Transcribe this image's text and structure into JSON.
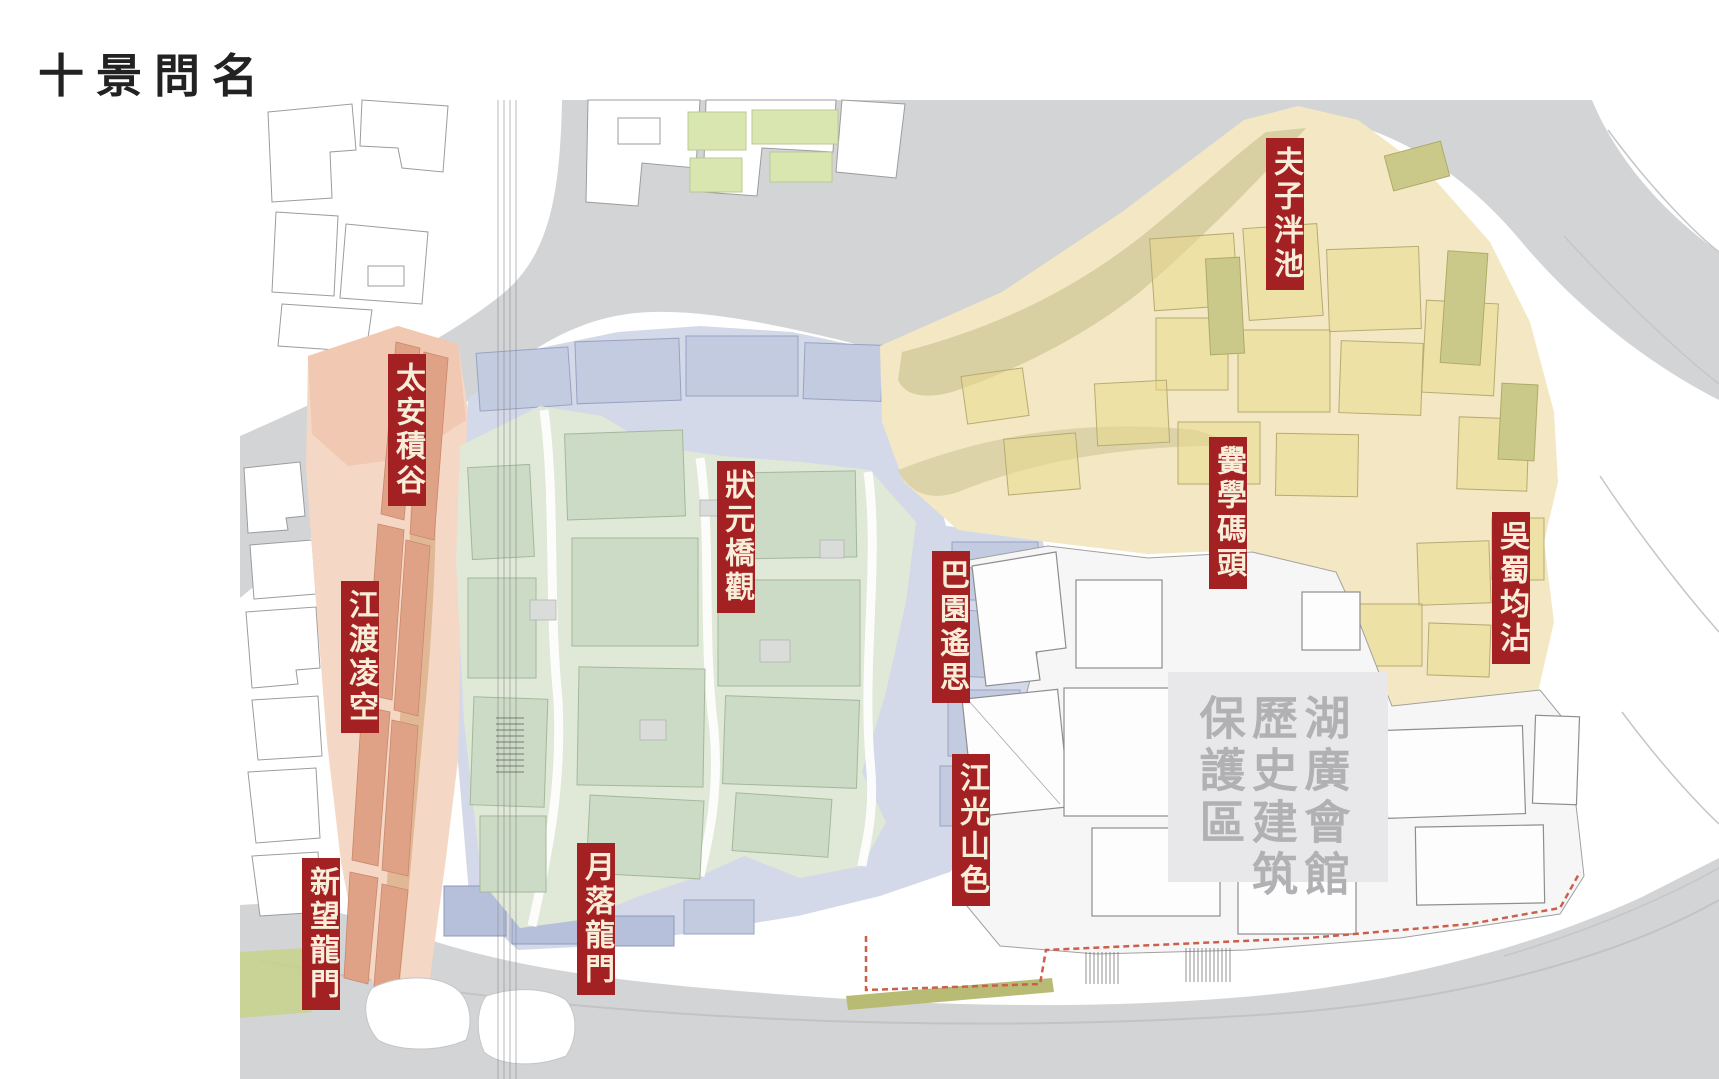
{
  "page": {
    "title": "十景問名"
  },
  "scene_labels": {
    "items": [
      {
        "id": "fuzi-panchi",
        "text": "夫子泮池",
        "x": 1266,
        "y": 138
      },
      {
        "id": "taian-jigu",
        "text": "太安積谷",
        "x": 388,
        "y": 354
      },
      {
        "id": "jiangdu-lingkong",
        "text": "江渡凌空",
        "x": 341,
        "y": 581
      },
      {
        "id": "xinwang-longmen",
        "text": "新望龍門",
        "x": 302,
        "y": 858
      },
      {
        "id": "yueluo-longmen",
        "text": "月落龍門",
        "x": 577,
        "y": 843
      },
      {
        "id": "zhuangyuan-qiaoguan",
        "text": "狀元橋觀",
        "x": 717,
        "y": 461
      },
      {
        "id": "bayuan-yaosi",
        "text": "巴園遙思",
        "x": 932,
        "y": 551
      },
      {
        "id": "jiangguang-shanse",
        "text": "江光山色",
        "x": 952,
        "y": 754
      },
      {
        "id": "hongxue-matou",
        "text": "黌學碼頭",
        "x": 1209,
        "y": 437
      },
      {
        "id": "wushu-junzhan",
        "text": "吳蜀均沾",
        "x": 1492,
        "y": 512
      }
    ]
  },
  "protection_area": {
    "label": "湖廣會館\n歷史建筑\n保護區"
  },
  "map": {
    "zones": [
      {
        "name": "yellow-zone",
        "color": "#f3e8c3"
      },
      {
        "name": "blue-zone",
        "color": "#d3d9e8"
      },
      {
        "name": "green-zone",
        "color": "#e0e8d7"
      },
      {
        "name": "pink-zone",
        "color": "#f5d7c5"
      },
      {
        "name": "road",
        "color": "#d3d4d6"
      }
    ],
    "label_red": "#a32123",
    "protection_text_gray": "#b1b1b4",
    "boundary_dash_red": "#cc5f4c"
  }
}
